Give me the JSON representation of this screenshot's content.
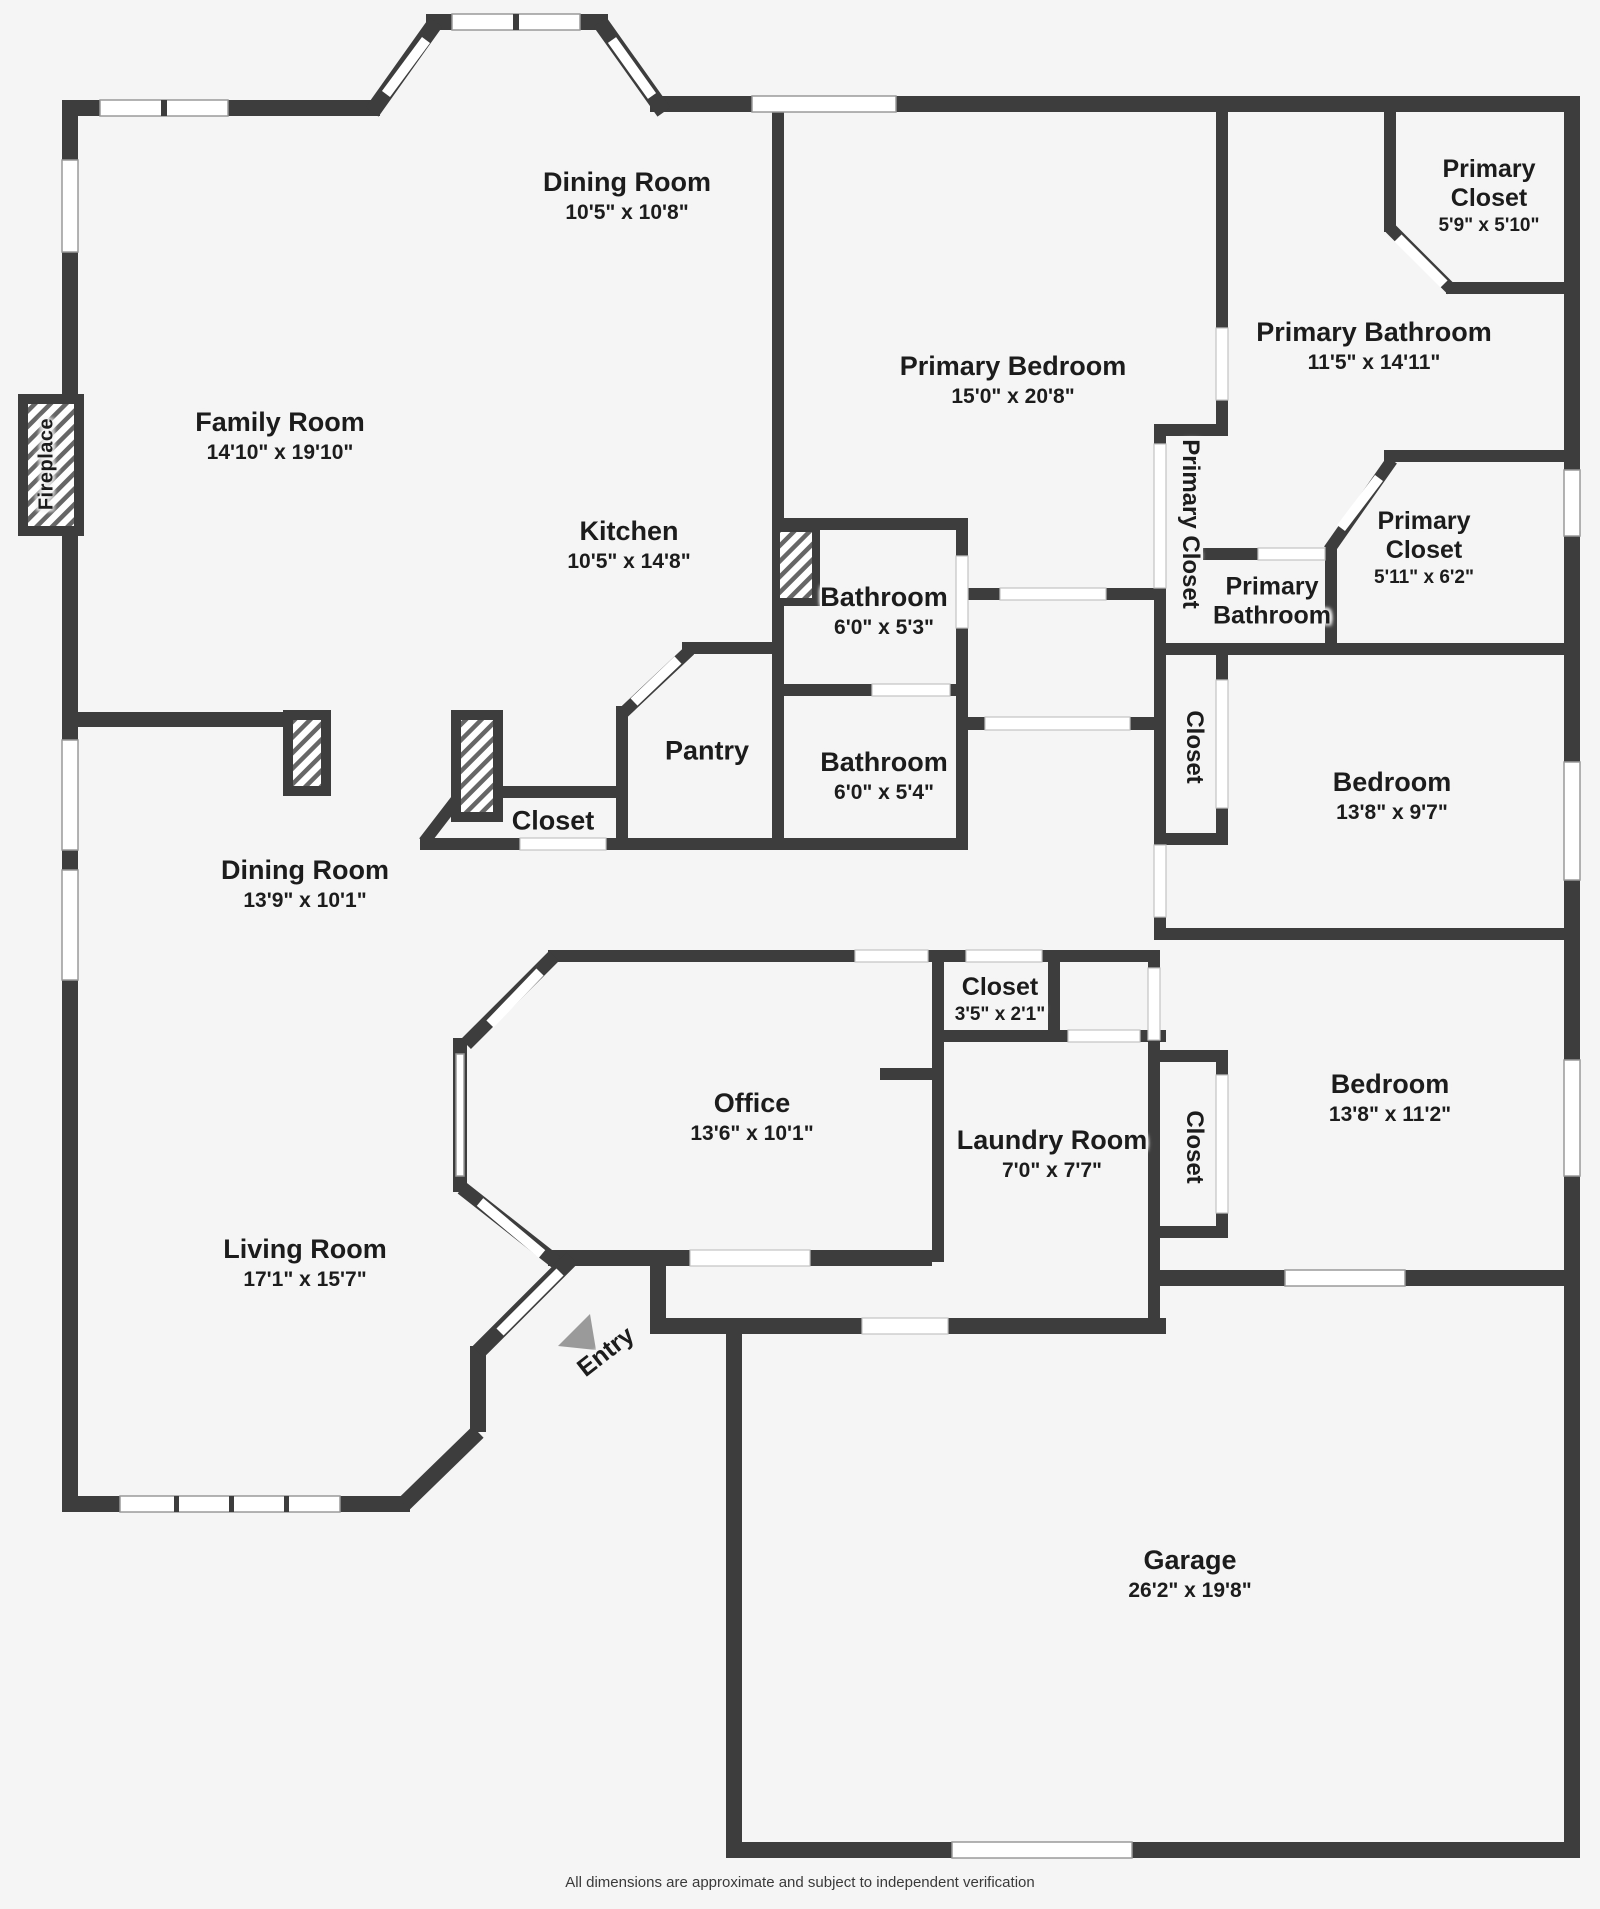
{
  "colors": {
    "wall": "#3d3d3d",
    "background": "#f5f5f5",
    "door": "#ffffff",
    "hatch_line": "#666666",
    "entry_arrow": "#9a9a9a",
    "label_text": "#1c1c1c"
  },
  "labels": [
    {
      "name": "Dining Room",
      "dims": "10'5\" x 10'8\""
    },
    {
      "name": "Family Room",
      "dims": "14'10\" x 19'10\""
    },
    {
      "name": "Primary Bedroom",
      "dims": "15'0\" x 20'8\""
    },
    {
      "name": "Primary Closet",
      "dims": "5'9\" x 5'10\""
    },
    {
      "name": "Primary Bathroom",
      "dims": "11'5\" x 14'11\""
    },
    {
      "name": "Kitchen",
      "dims": "10'5\" x 14'8\""
    },
    {
      "name": "Bathroom",
      "dims": "6'0\" x 5'3\""
    },
    {
      "name": "Primary Closet",
      "dims": ""
    },
    {
      "name": "Primary Bathroom",
      "dims": ""
    },
    {
      "name": "Primary Closet",
      "dims": "5'11\" x 6'2\""
    },
    {
      "name": "Pantry",
      "dims": ""
    },
    {
      "name": "Bathroom",
      "dims": "6'0\" x 5'4\""
    },
    {
      "name": "Closet",
      "dims": ""
    },
    {
      "name": "Closet",
      "dims": ""
    },
    {
      "name": "Bedroom",
      "dims": "13'8\" x 9'7\""
    },
    {
      "name": "Dining Room",
      "dims": "13'9\" x 10'1\""
    },
    {
      "name": "Closet",
      "dims": "3'5\" x 2'1\""
    },
    {
      "name": "Office",
      "dims": "13'6\" x 10'1\""
    },
    {
      "name": "Laundry Room",
      "dims": "7'0\" x 7'7\""
    },
    {
      "name": "Closet",
      "dims": ""
    },
    {
      "name": "Bedroom",
      "dims": "13'8\" x 11'2\""
    },
    {
      "name": "Living Room",
      "dims": "17'1\" x 15'7\""
    },
    {
      "name": "Garage",
      "dims": "26'2\" x 19'8\""
    },
    {
      "name": "Fireplace",
      "dims": ""
    },
    {
      "name": "Entry",
      "dims": ""
    }
  ],
  "footer": {
    "disclaimer": "All dimensions are approximate and subject to independent verification"
  }
}
